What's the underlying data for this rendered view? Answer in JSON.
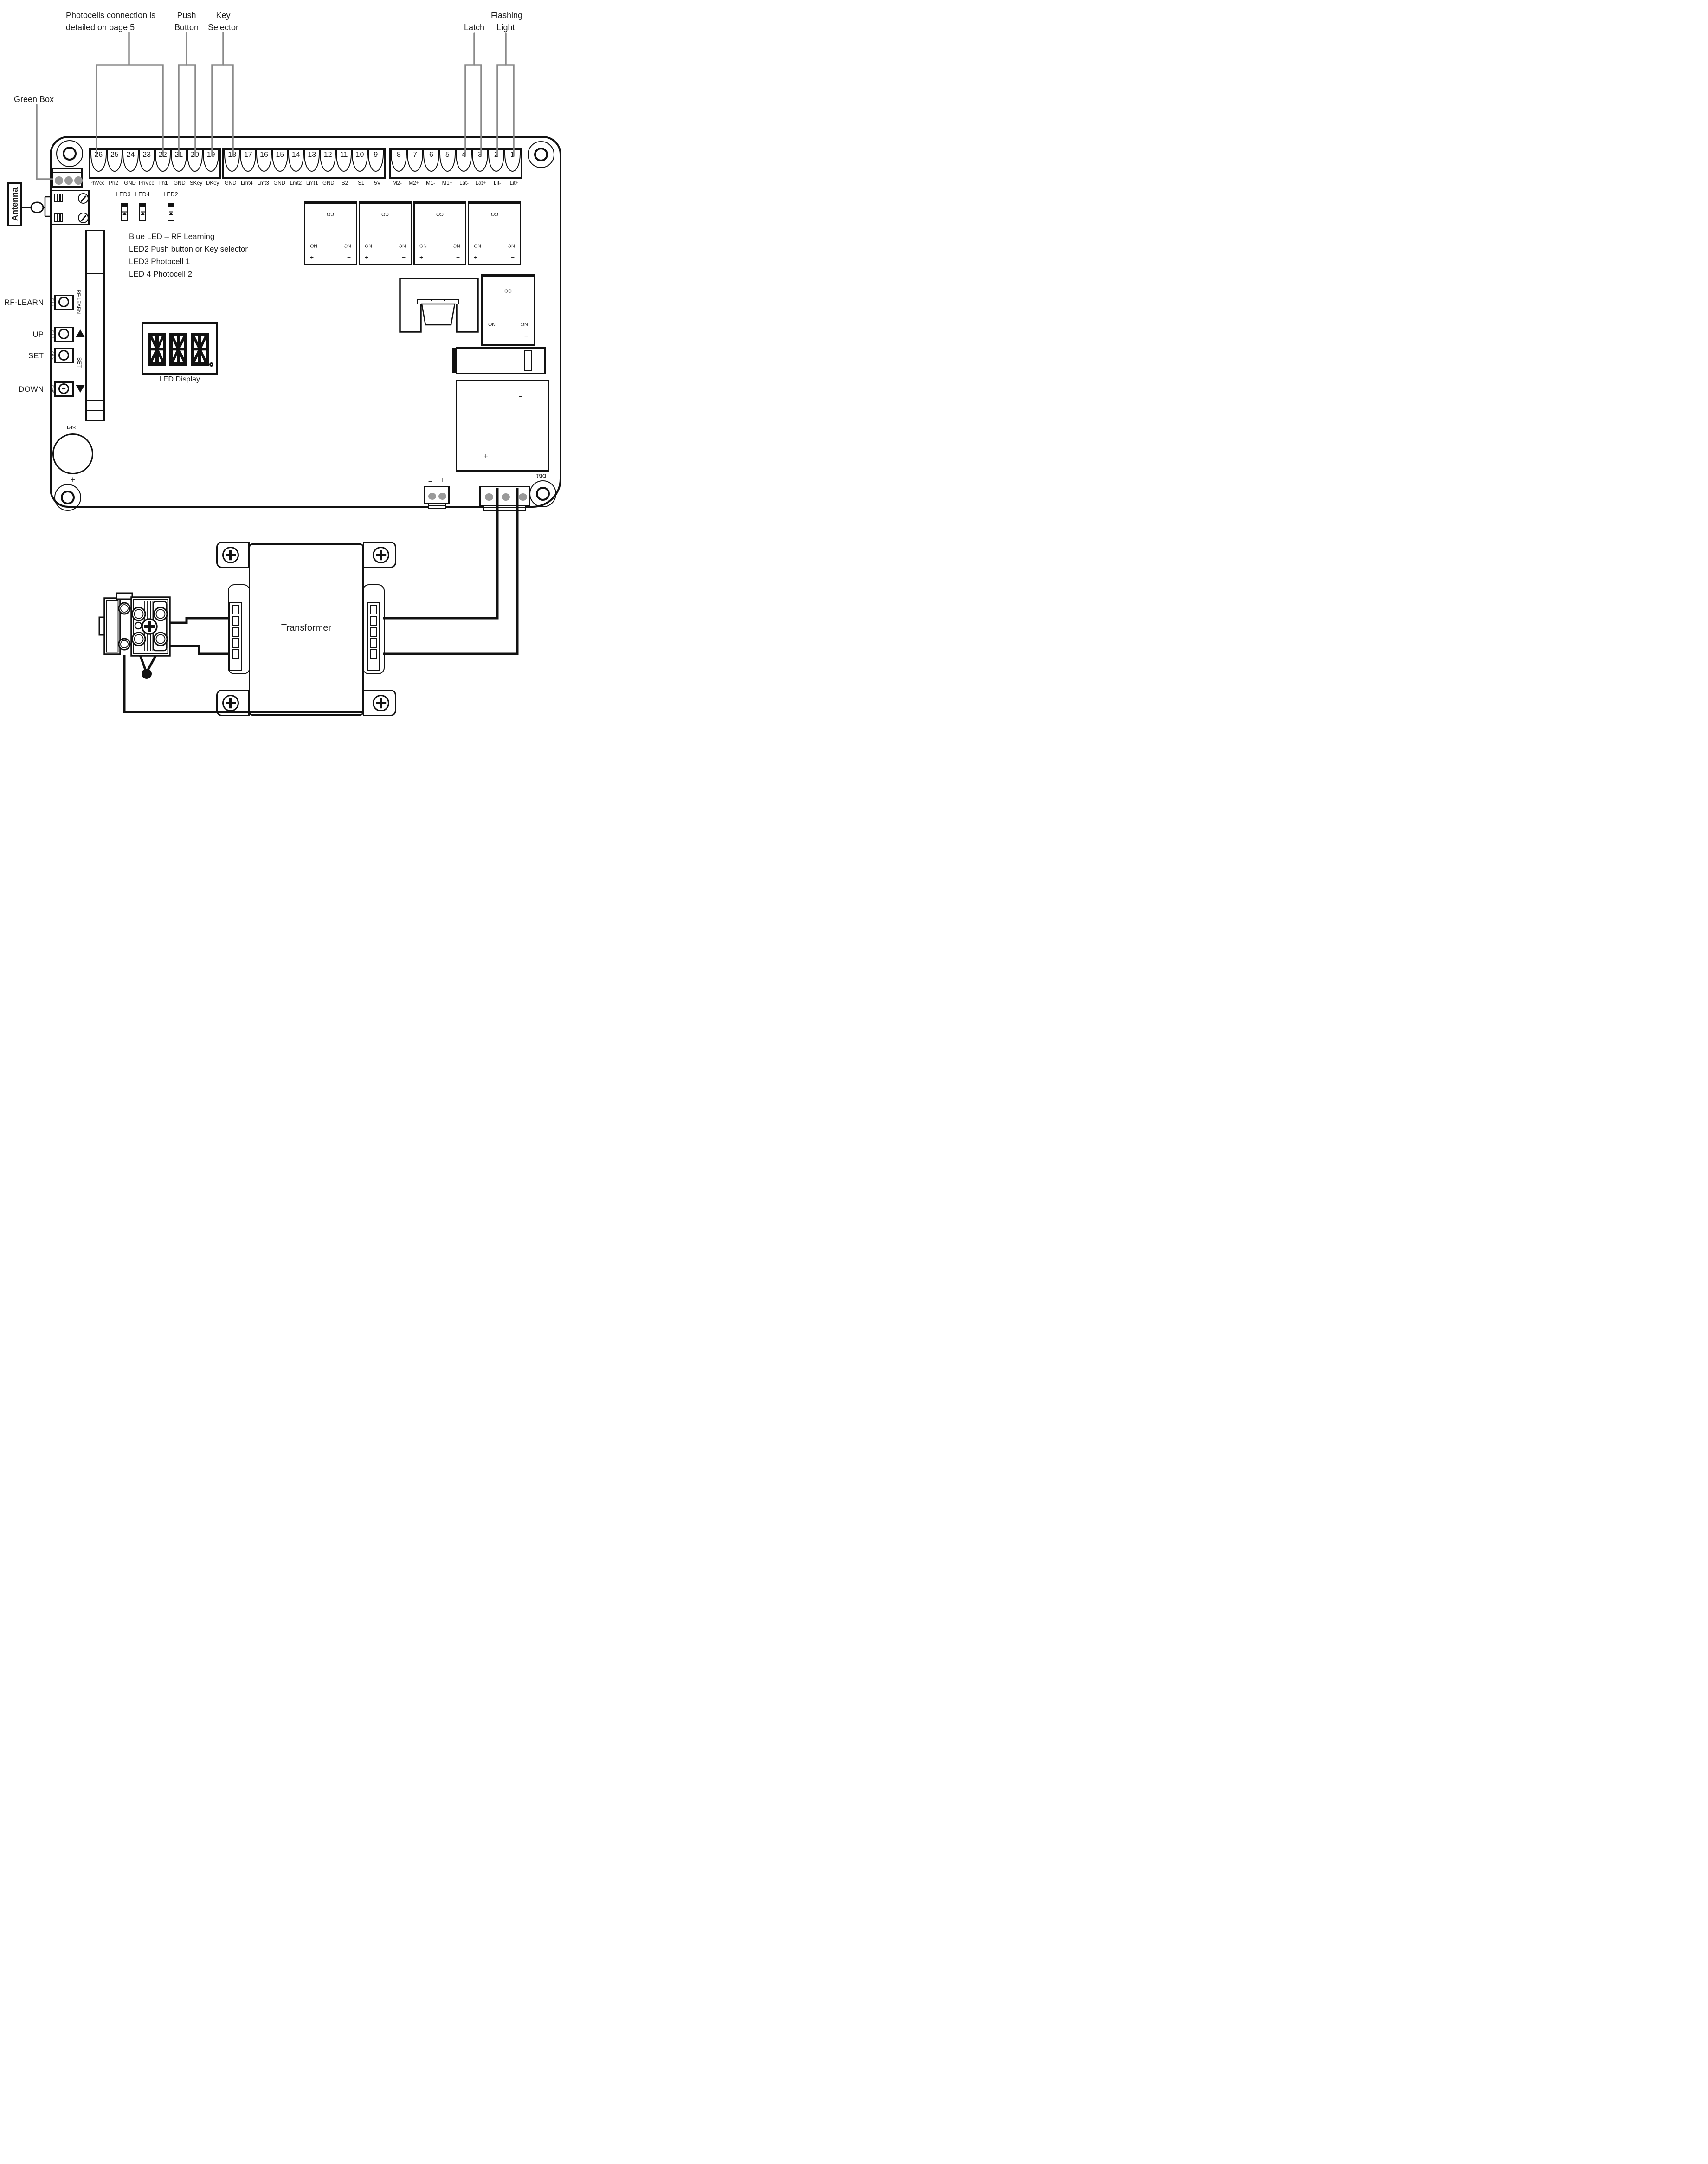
{
  "callouts": {
    "photocells_1": "Photocells connection is",
    "photocells_2": "detailed on page 5",
    "push_1": "Push",
    "push_2": "Button",
    "key_1": "Key",
    "key_2": "Selector",
    "flashing": "Flashing",
    "latch": "Latch",
    "light": "Light",
    "green_box": "Green Box",
    "antenna": "Antenna",
    "antenna_ref": "11"
  },
  "terminal_blocks": [
    {
      "terminals": [
        {
          "num": "26",
          "label": "PhVcc"
        },
        {
          "num": "25",
          "label": "Ph2"
        },
        {
          "num": "24",
          "label": "GND"
        },
        {
          "num": "23",
          "label": "PhVcc"
        },
        {
          "num": "22",
          "label": "Ph1"
        },
        {
          "num": "21",
          "label": "GND"
        },
        {
          "num": "20",
          "label": "SKey"
        },
        {
          "num": "19",
          "label": "DKey"
        }
      ]
    },
    {
      "terminals": [
        {
          "num": "18",
          "label": "GND"
        },
        {
          "num": "17",
          "label": "Lmt4"
        },
        {
          "num": "16",
          "label": "Lmt3"
        },
        {
          "num": "15",
          "label": "GND"
        },
        {
          "num": "14",
          "label": "Lmt2"
        },
        {
          "num": "13",
          "label": "Lmt1"
        },
        {
          "num": "12",
          "label": "GND"
        },
        {
          "num": "11",
          "label": "S2"
        },
        {
          "num": "10",
          "label": "S1"
        },
        {
          "num": "9",
          "label": "5V"
        }
      ]
    },
    {
      "terminals": [
        {
          "num": "8",
          "label": "M2-"
        },
        {
          "num": "7",
          "label": "M2+"
        },
        {
          "num": "6",
          "label": "M1-"
        },
        {
          "num": "5",
          "label": "M1+"
        },
        {
          "num": "4",
          "label": "Lat-"
        },
        {
          "num": "3",
          "label": "Lat+"
        },
        {
          "num": "2",
          "label": "Lit-"
        },
        {
          "num": "1",
          "label": "Lit+"
        }
      ]
    }
  ],
  "antenna_terminals": {
    "gnd": "GND",
    "ant": "ANT"
  },
  "led_labels": {
    "led3": "LED3",
    "led4": "LED4",
    "led2": "LED2"
  },
  "led_notes": [
    "Blue LED – RF Learning",
    "LED2 Push button or Key selector",
    "LED3 Photocell 1",
    "LED 4 Photocell 2"
  ],
  "buttons": {
    "rf_learn": {
      "label": "RF-LEARN",
      "sw": "SW1",
      "side": "RF-LEARN",
      "plus": "+"
    },
    "up": {
      "label": "UP",
      "sw": "SW3",
      "plus": "+"
    },
    "set": {
      "label": "SET",
      "sw": "SW4",
      "side": "SET",
      "plus": "+"
    },
    "down": {
      "label": "DOWN",
      "sw": "SW5",
      "plus": "+"
    }
  },
  "rf_module": {
    "ref": "RF1"
  },
  "led_display": {
    "label": "LED Display"
  },
  "relays": [
    {
      "co": "CO",
      "no": "NO",
      "nc": "NC",
      "plus": "+",
      "minus": "−"
    },
    {
      "co": "CO",
      "no": "NO",
      "nc": "NC",
      "plus": "+",
      "minus": "−"
    },
    {
      "co": "CO",
      "no": "NO",
      "nc": "NC",
      "plus": "+",
      "minus": "−"
    },
    {
      "co": "CO",
      "no": "NO",
      "nc": "NC",
      "plus": "+",
      "minus": "−"
    }
  ],
  "relay5": {
    "co": "CO",
    "no": "NO",
    "nc": "NC",
    "plus": "+",
    "minus": "−"
  },
  "speaker": {
    "ref": "SP1",
    "plus": "+"
  },
  "db1": {
    "ref": "DB1",
    "plus": "+",
    "minus": "−"
  },
  "battery_connector": {
    "minus": "−",
    "plus": "+"
  },
  "transformer": {
    "label": "Transformer"
  },
  "colors": {
    "wire_gray": "#8a8a8a",
    "connector_dot_gray": "#9a9a9a",
    "ink": "#1a1a1a"
  }
}
